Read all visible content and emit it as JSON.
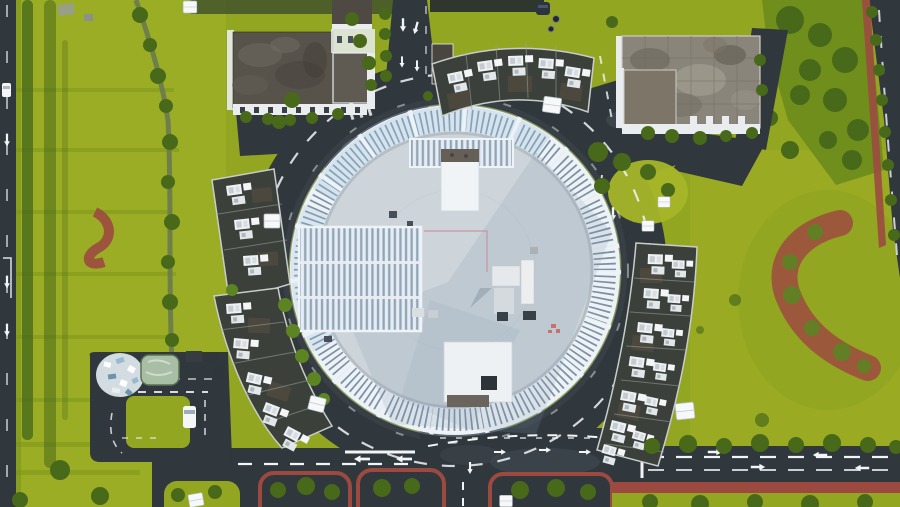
{
  "scene": {
    "title": "Aerial top-down drone photo of a circular white-roofed hall surrounded by a ring road, curved rows of small houses, rectangular buildings, lawns and streets",
    "setting": "daytime aerial photograph, no visible text",
    "landmarks": [
      {
        "name": "central-building",
        "description": "large circular hall, white louvered perimeter ring, pale grey roof deck"
      },
      {
        "name": "ribbed-annex-roof",
        "description": "rectangular white-ribbed roof section on west side of the circle"
      },
      {
        "name": "north-roof-annex",
        "description": "small rectangular protrusion on north edge of circular roof"
      },
      {
        "name": "south-roof-annex",
        "description": "small rectangular protrusion on south edge of circular roof"
      },
      {
        "name": "rooftop-equipment",
        "description": "HVAC boxes and vents near roof center"
      },
      {
        "name": "ring-road",
        "description": "dark asphalt loop with dashed white lane markings around the hall"
      },
      {
        "name": "northwest-building",
        "description": "rectangular building with dark weathered flat roof and annex"
      },
      {
        "name": "northeast-building",
        "description": "rectangular building with mottled grey-brown grid roof and white walls"
      },
      {
        "name": "north-house-cluster",
        "description": "curved row of five units with white rooftop equipment"
      },
      {
        "name": "west-house-cluster",
        "description": "short slanted row of three units"
      },
      {
        "name": "southwest-house-cluster",
        "description": "curved row of five units following the ring road"
      },
      {
        "name": "east-house-cluster",
        "description": "long curved row of units hugging the east side of the ring road"
      },
      {
        "name": "south-boulevard",
        "description": "wide road along bottom with arrows, dashed lines and junction"
      },
      {
        "name": "traffic-islands",
        "description": "rounded grass islands, several edged in red brick"
      },
      {
        "name": "red-footpath",
        "description": "brick-red walkway strips on right and bottom-right"
      },
      {
        "name": "left-road",
        "description": "vertical road at far left edge with white arrows"
      },
      {
        "name": "top-road",
        "description": "short vertical access road at top center with fork arrows"
      },
      {
        "name": "right-diagonal-road",
        "description": "road running diagonally along top-right edge"
      },
      {
        "name": "practice-area",
        "description": "small asphalt loop at lower left with white van and markings"
      },
      {
        "name": "pond",
        "description": "small pale-green pond"
      },
      {
        "name": "debris-pile",
        "description": "heap of white and blue scrap material"
      },
      {
        "name": "crescent-hedge",
        "description": "large C-shaped dark shrub bed on east lawn"
      },
      {
        "name": "diagonal-tree-line",
        "description": "tree and hedge line crossing the west meadow"
      },
      {
        "name": "white-canopies",
        "description": "several small white tents scattered on lawns"
      },
      {
        "name": "vehicles",
        "description": "white car on left road, white van in practice area, dark car at top"
      }
    ]
  },
  "colors": {
    "grass_base": "#93a621",
    "grass_light": "#a6b528",
    "grass_dark": "#758f1a",
    "hedge_dark": "#48691a",
    "hedge_light": "#5d8423",
    "road": "#30373d",
    "road_worn": "#4a525a",
    "marking_white": "#f2f5f7",
    "roof_circle": "#ced5da",
    "louver_white": "#edf2f7",
    "louver_slat": "#60788c",
    "ribbed_panel": "#e4edf5",
    "shadow_blue": "#7e97ab",
    "dark_roof": "#57534b",
    "mottled_roof": "#8a857b",
    "cluster_roof": "#3b403b",
    "unit_white": "#f4f6f7",
    "brick_red": "#9c4a40",
    "wall_white": "#e9edf0",
    "pond_green": "#a8bfa6",
    "debris_white": "#d3dce1",
    "glass_blue": "#9fc3dd"
  }
}
